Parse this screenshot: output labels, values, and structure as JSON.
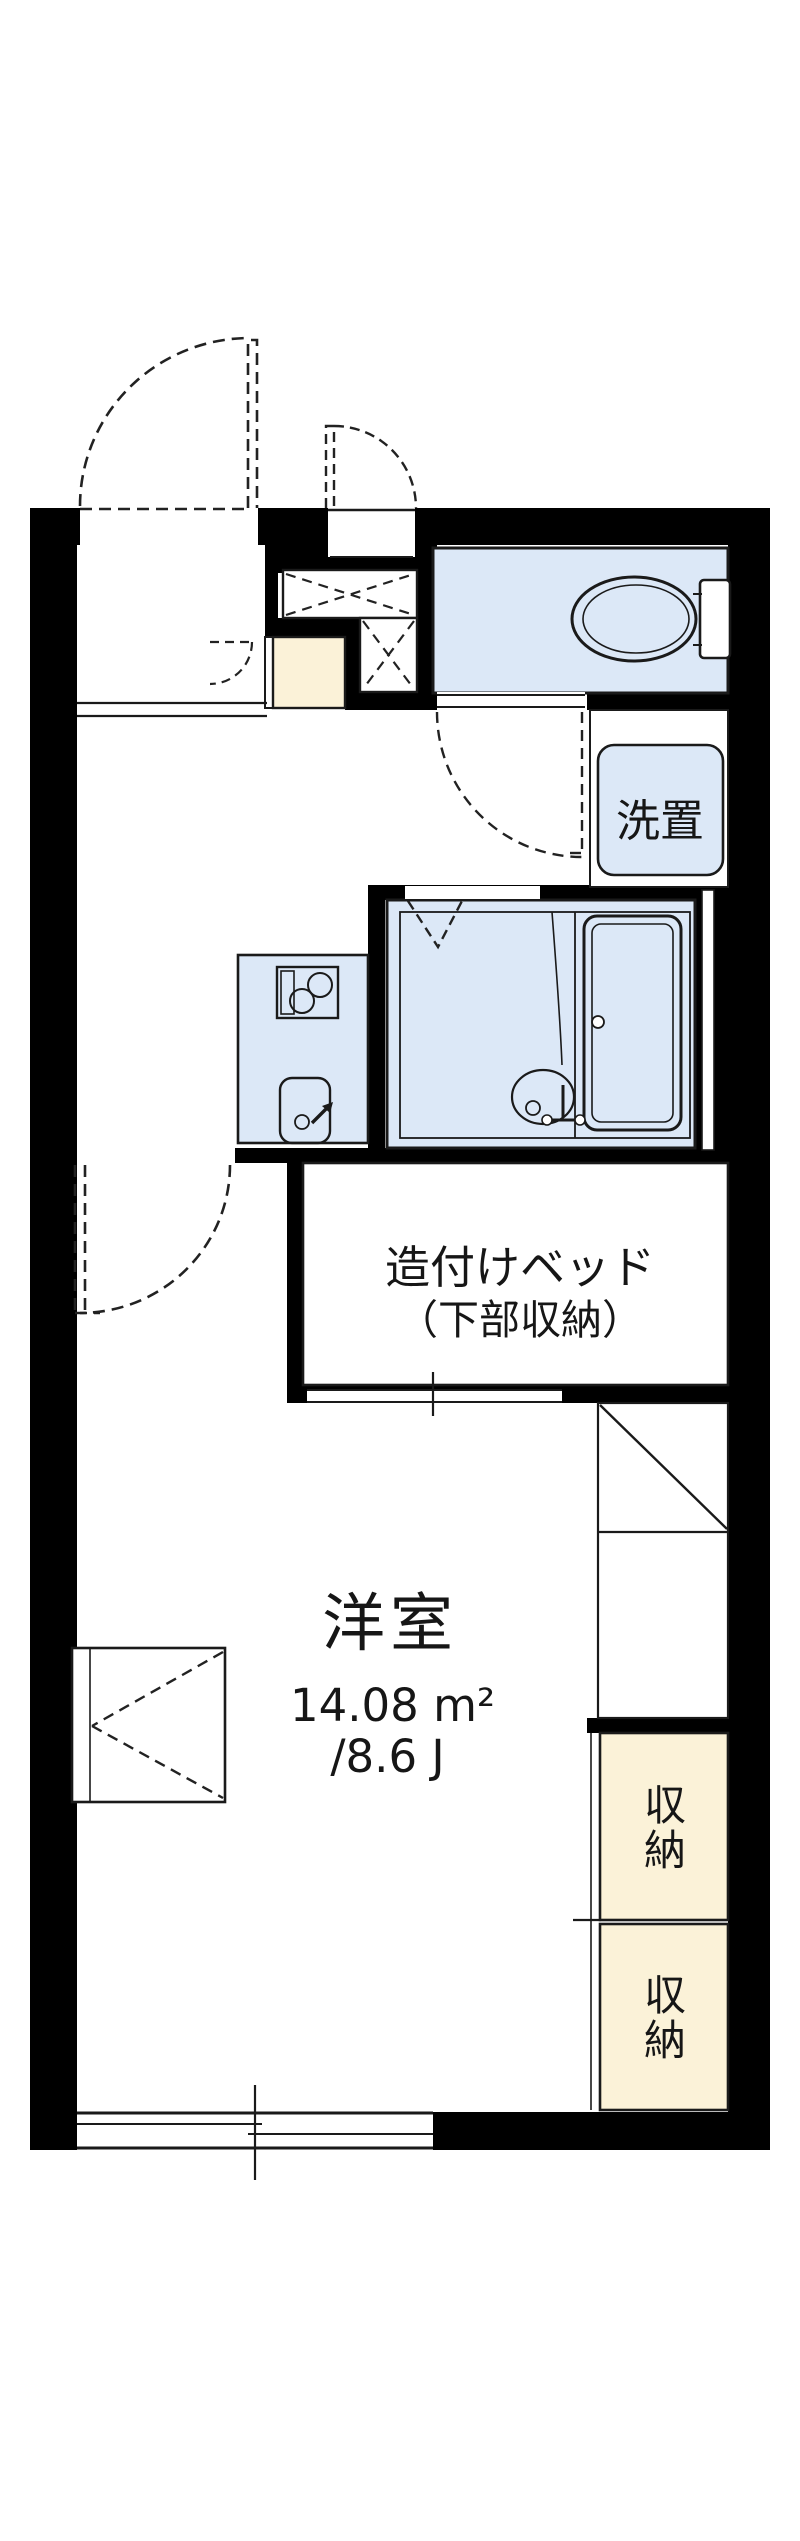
{
  "floorplan": {
    "labels": {
      "washer": "洗置",
      "bed_line1": "造付けベッド",
      "bed_line2": "（下部収納）",
      "main_room_name": "洋室",
      "main_room_area_sqm": "14.08 m²",
      "main_room_area_jo": "/8.6 J",
      "storage_upper": "収納",
      "storage_lower": "収納"
    },
    "colors": {
      "wall": "#7c7d84",
      "water_floor": "#dce8f7",
      "storage_fill": "#fbf2d8",
      "line": "#1a1a1a",
      "paper": "#ffffff"
    }
  }
}
